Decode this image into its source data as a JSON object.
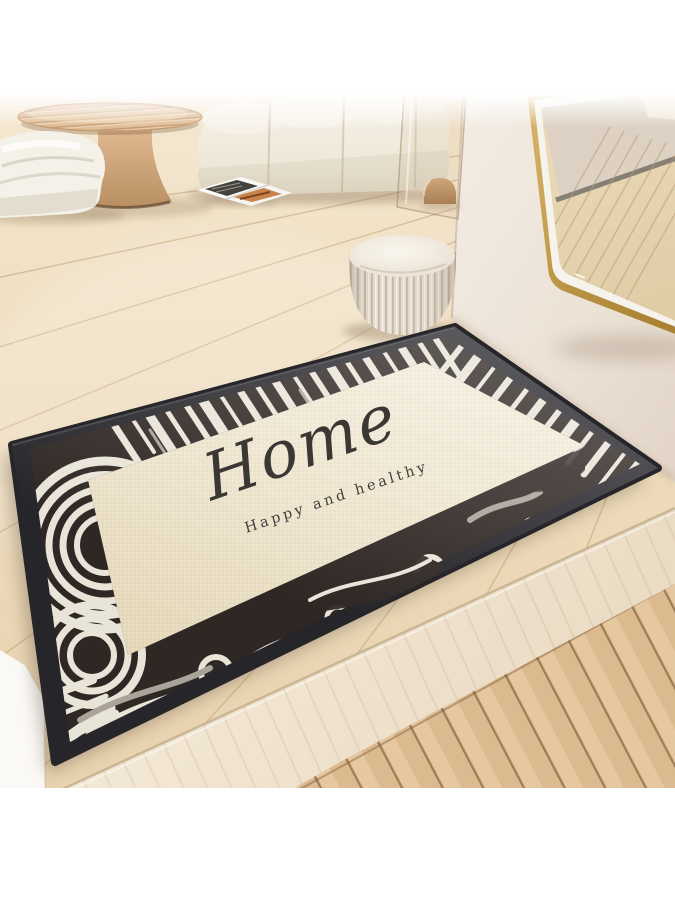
{
  "mat": {
    "title": "Home",
    "subtitle": "Happy and healthy",
    "title_color": "#3a3734",
    "subtitle_color": "#433f3a",
    "binding_color": "#26252a",
    "border_dark": "#2f2724",
    "border_stripe_light": "#e9e4d8",
    "field_color": "#efe6d0"
  },
  "scene": {
    "background_color": "#ffffff",
    "wall_color": "#efe7dd",
    "floor_color": "#f0e1c6",
    "foreground_floor_color": "#dcba8f",
    "platform_edge_color": "#f2e7d5",
    "mirror_frame_color": "#c9a254",
    "pouf_color": "#e9e1d3",
    "sofa_color": "#f2ede2",
    "lounge_chair_color": "#f4f1e9",
    "coffee_table_color": "#d9b089"
  }
}
